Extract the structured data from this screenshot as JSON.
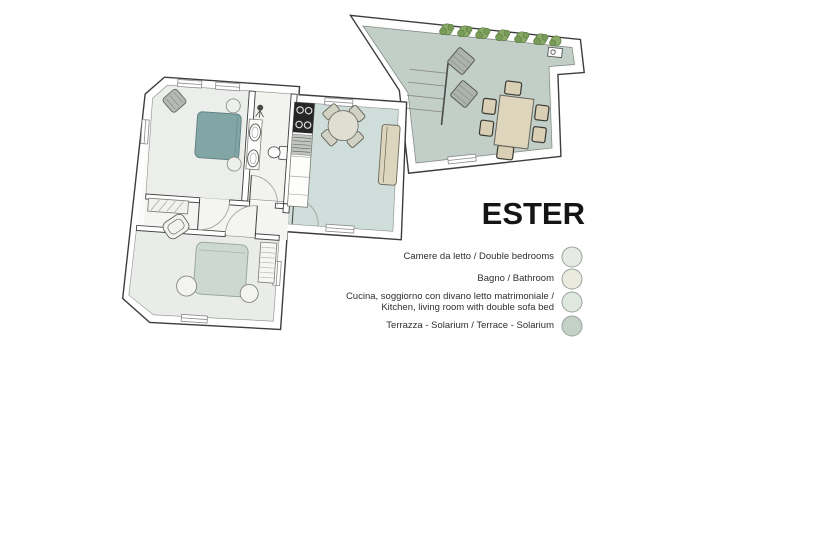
{
  "title": "ESTER",
  "legend": [
    {
      "label": "Camere da letto / Double bedrooms",
      "color": "#e7e9e5"
    },
    {
      "label": "Bagno / Bathroom",
      "color": "#eaeadf"
    },
    {
      "label": "Cucina, soggiorno con divano letto matrimoniale /",
      "label_line2": "Kitchen, living room with double sofa bed",
      "color": "#dfe8de"
    },
    {
      "label": "Terrazza - Solarium / Terrace - Solarium",
      "color": "#c4d1c7"
    }
  ],
  "floorplan": {
    "rooms": [
      {
        "name": "bedroom-1",
        "color": "#eceeec"
      },
      {
        "name": "bathroom",
        "color": "#f2f3ef"
      },
      {
        "name": "kitchen-living-room",
        "color": "#cfdeda"
      },
      {
        "name": "hallway",
        "color": "#f4f5f3"
      },
      {
        "name": "bedroom-2",
        "color": "#e9ece8"
      },
      {
        "name": "terrace-solarium",
        "color": "#c2cfc8"
      }
    ],
    "furniture": {
      "double_bed": "#82a5a5",
      "bed_2": "#ccd8d1",
      "sofa": "#ddd6bf",
      "dining_table": "#ded5bd",
      "plant": "#8aab67"
    }
  }
}
